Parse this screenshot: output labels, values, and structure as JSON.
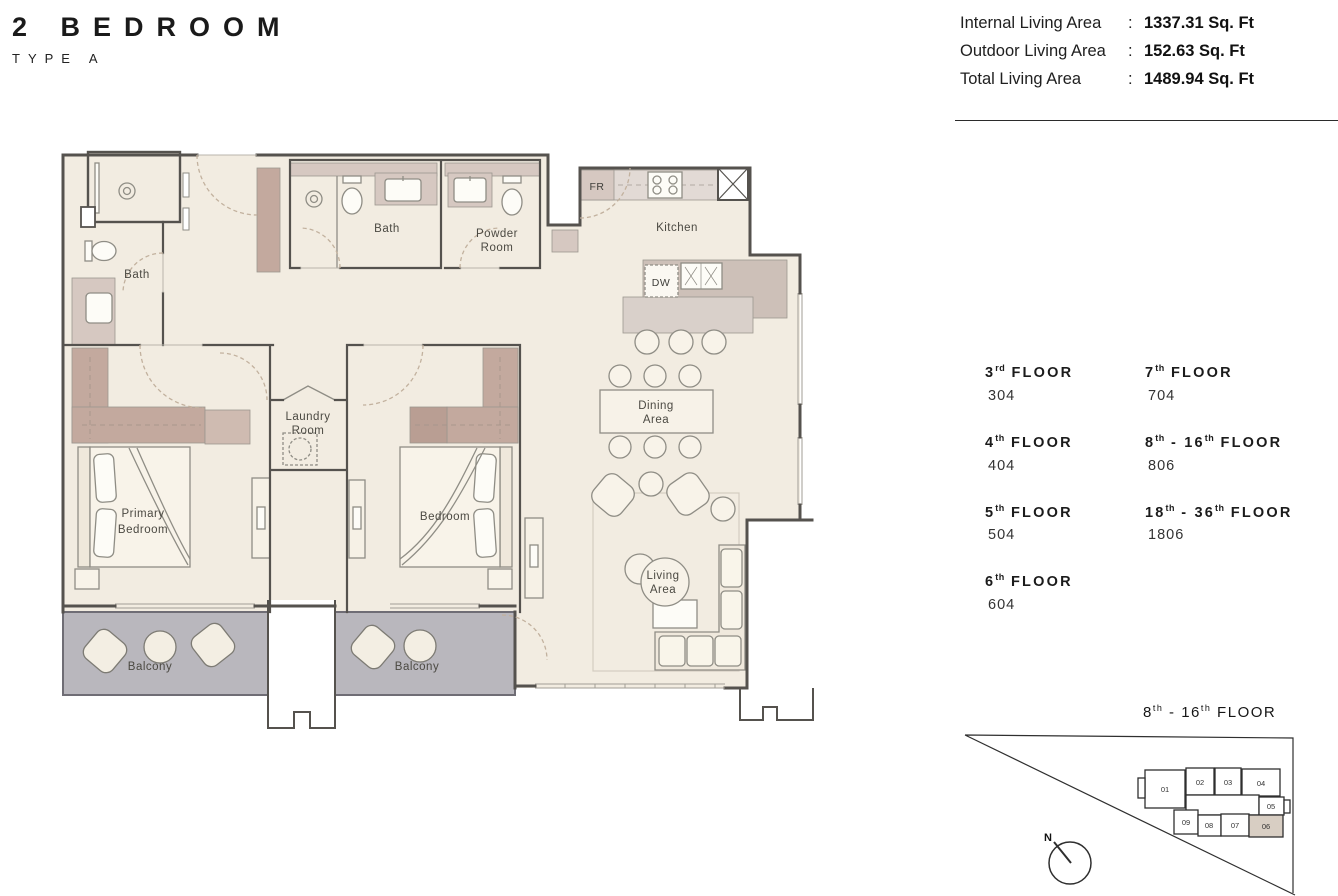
{
  "header": {
    "title": "2 BEDROOM",
    "subtitle": "TYPE A"
  },
  "areas": {
    "rows": [
      {
        "label": "Internal Living Area",
        "colon": ":",
        "value": "1337.31 Sq. Ft"
      },
      {
        "label": "Outdoor Living Area",
        "colon": ":",
        "value": "152.63 Sq. Ft"
      },
      {
        "label": "Total Living Area",
        "colon": ":",
        "value": "1489.94 Sq. Ft"
      }
    ]
  },
  "floors": {
    "left": [
      {
        "num": "3",
        "sup": "rd",
        "tail": " FLOOR",
        "unit": "304"
      },
      {
        "num": "4",
        "sup": "th",
        "tail": " FLOOR",
        "unit": "404"
      },
      {
        "num": "5",
        "sup": "th",
        "tail": " FLOOR",
        "unit": "504"
      },
      {
        "num": "6",
        "sup": "th",
        "tail": " FLOOR",
        "unit": "604"
      }
    ],
    "right": [
      {
        "num": "7",
        "sup": "th",
        "tail": " FLOOR",
        "unit": "704"
      },
      {
        "num": "8",
        "sup": "th",
        "mid": " - 16",
        "sup2": "th",
        "tail": " FLOOR",
        "unit": "806"
      },
      {
        "num": "18",
        "sup": "th",
        "mid": " - 36",
        "sup2": "th",
        "tail": " FLOOR",
        "unit": "1806"
      }
    ]
  },
  "keyplan": {
    "title": {
      "num": "8",
      "sup": "th",
      "mid": " - 16",
      "sup2": "th",
      "tail": " FLOOR"
    },
    "north_label": "N",
    "units": [
      "01",
      "02",
      "03",
      "04",
      "05",
      "06",
      "07",
      "08",
      "09"
    ],
    "highlighted_unit": "06",
    "highlight_color": "#d8cec3"
  },
  "plan": {
    "labels": {
      "bath1": "Bath",
      "bath2": "Bath",
      "powder1": "Powder",
      "powder2": "Room",
      "kitchen": "Kitchen",
      "fr": "FR",
      "dw": "DW",
      "laundry1": "Laundry",
      "laundry2": "Room",
      "primary1": "Primary",
      "primary2": "Bedroom",
      "bedroom": "Bedroom",
      "dining1": "Dining",
      "dining2": "Area",
      "living1": "Living",
      "living2": "Area",
      "balcony_left": "Balcony",
      "balcony_right": "Balcony"
    },
    "colors": {
      "floor": "#f2ece1",
      "accent": "#c3a99e",
      "accent_light": "#d6c8c1",
      "counter": "#e2dad5",
      "island_top": "#cdc0b8",
      "island_base": "#d9d0ca",
      "balcony": "#b9b7bd",
      "wall": "#55524e",
      "stroke": "#8f8d85",
      "door": "#c2b19e",
      "win": "#a29e96",
      "text": "#4b4942"
    }
  }
}
